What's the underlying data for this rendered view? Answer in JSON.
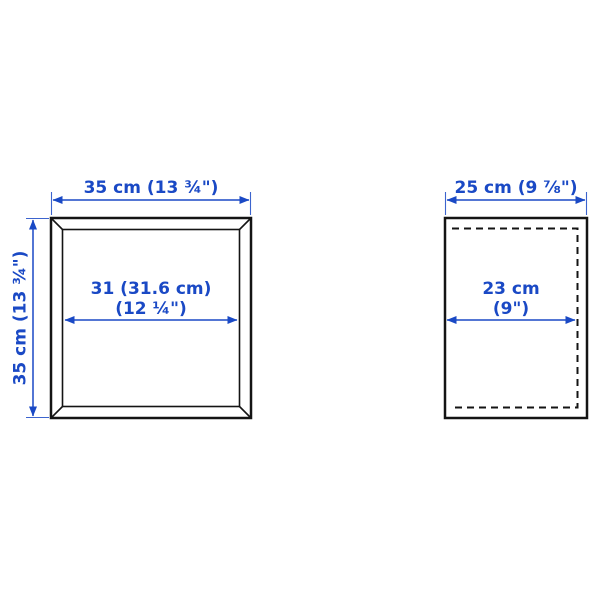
{
  "figure": {
    "kind": "product-dimension-diagram",
    "front_view": {
      "width_label": "35 cm (13 ¾\")",
      "height_label": "35 cm (13 ¾\")",
      "inner_width_line1": "31 (31.6 cm)",
      "inner_width_line2": "(12 ¼\")"
    },
    "side_view": {
      "depth_label": "25 cm (9 ⅞\")",
      "inner_depth_line1": "23 cm",
      "inner_depth_line2": "(9\")"
    }
  },
  "colors": {
    "dimension_blue": "#1a49c5",
    "line_color": "#141414",
    "background": "#ffffff"
  }
}
